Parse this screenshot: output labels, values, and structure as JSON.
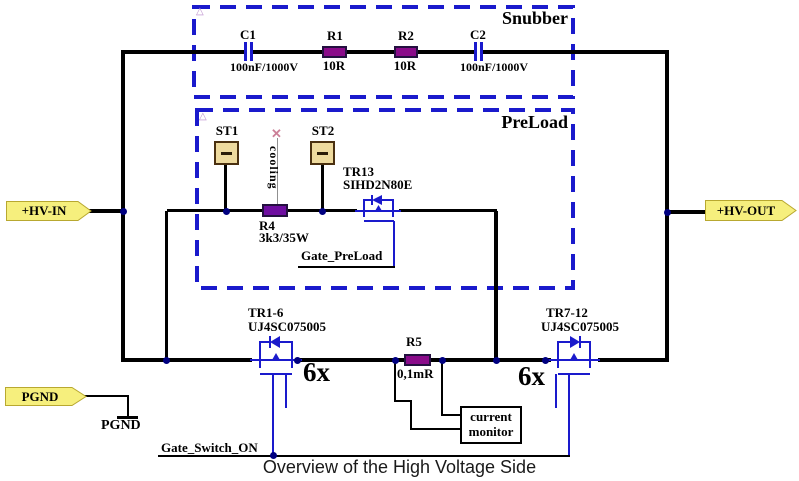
{
  "title": "Overview of the High Voltage Side",
  "colors": {
    "dashed_box": "#1a1acc",
    "mosfet_symbol": "#1a1acc",
    "resistor_fill": "#8a0b8a",
    "resistor_r4_fill": "#6e0da0",
    "tag_fill": "#f6ef7d",
    "junction_dot": "#000080",
    "wire": "#000000",
    "st_box_fill": "#eeda9e"
  },
  "tags": {
    "hv_in": "+HV-IN",
    "hv_out": "+HV-OUT",
    "pgnd": "PGND"
  },
  "ground": {
    "label": "PGND"
  },
  "snubber": {
    "label": "Snubber",
    "c1": {
      "ref": "C1",
      "value": "100nF/1000V"
    },
    "r1": {
      "ref": "R1",
      "value": "10R"
    },
    "r2": {
      "ref": "R2",
      "value": "10R"
    },
    "c2": {
      "ref": "C2",
      "value": "100nF/1000V"
    }
  },
  "preload": {
    "label": "PreLoad",
    "st1": {
      "ref": "ST1"
    },
    "st2": {
      "ref": "ST2"
    },
    "cooling_label": "cooling",
    "r4": {
      "ref": "R4",
      "value": "3k3/35W"
    },
    "tr13": {
      "ref": "TR13",
      "part": "SIHD2N80E"
    },
    "gate_label": "Gate_PreLoad"
  },
  "switch_stage": {
    "tr1_6": {
      "ref": "TR1-6",
      "part": "UJ4SC075005",
      "count": "6x"
    },
    "tr7_12": {
      "ref": "TR7-12",
      "part": "UJ4SC075005",
      "count": "6x"
    },
    "r5": {
      "ref": "R5",
      "value": "0,1mR"
    },
    "monitor": {
      "line1": "current",
      "line2": "monitor"
    },
    "gate_label": "Gate_Switch_ON"
  }
}
